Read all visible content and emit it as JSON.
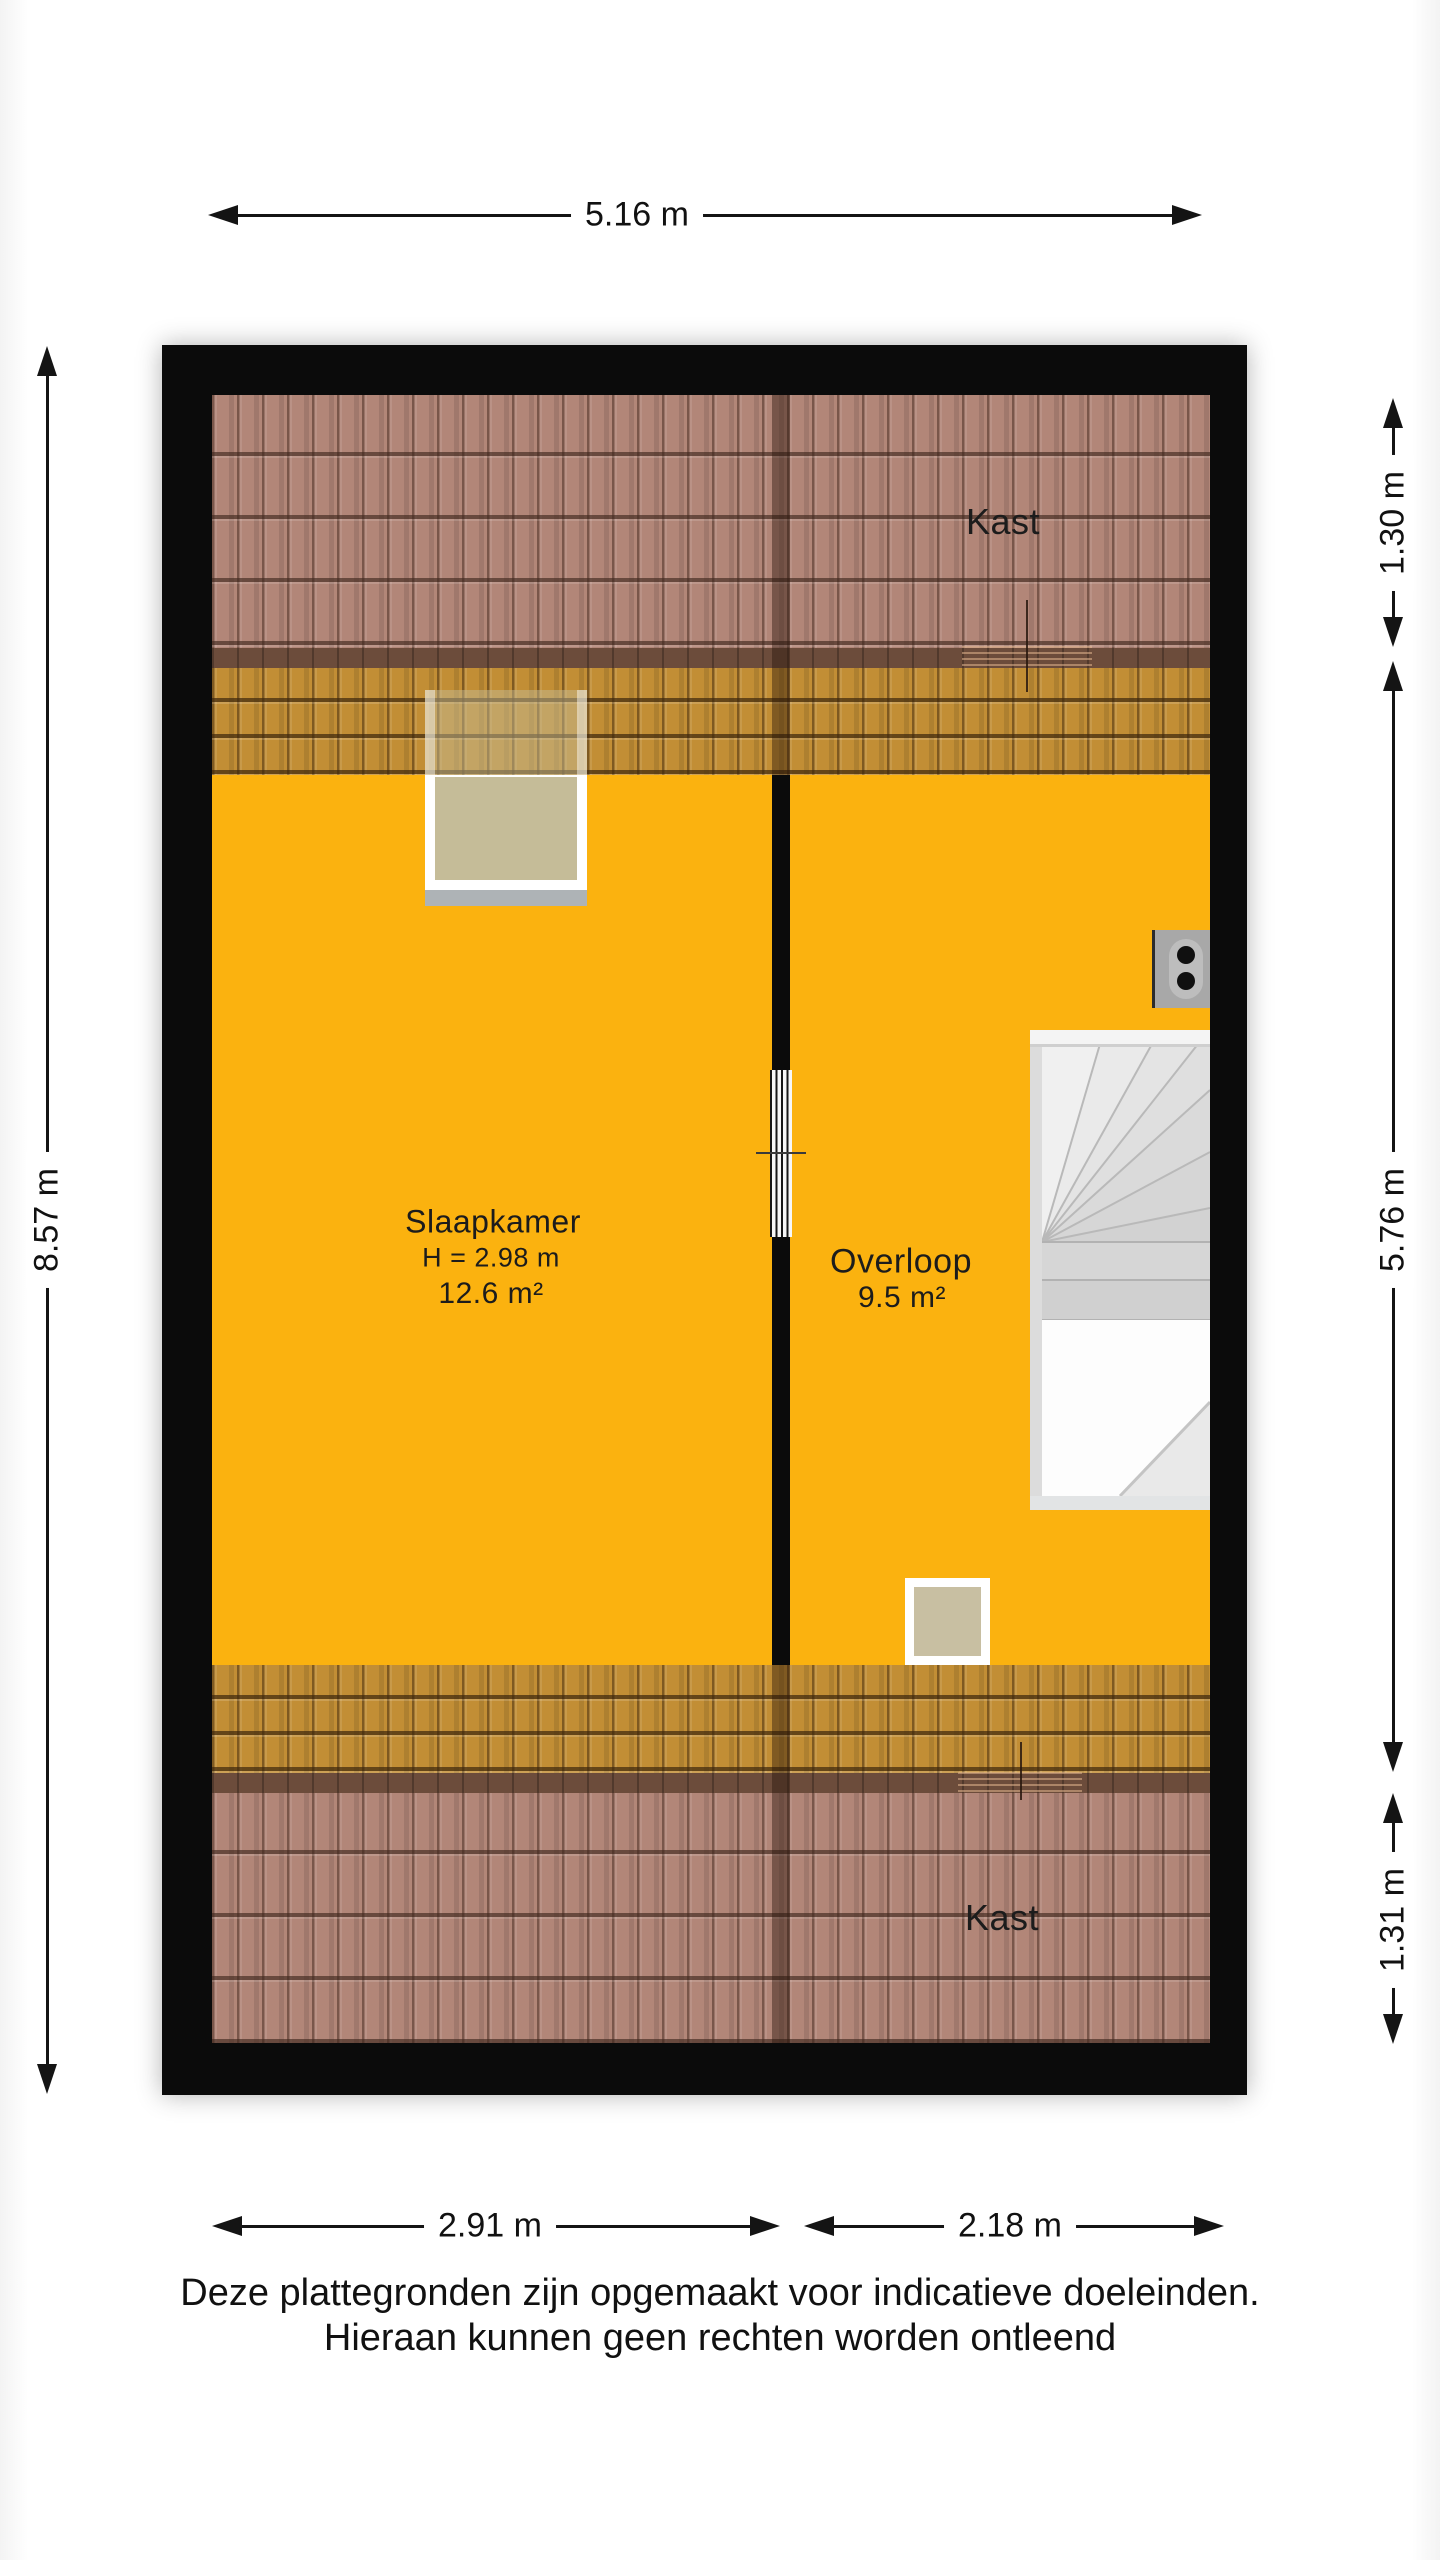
{
  "floorplan": {
    "rooms": {
      "kast_top": {
        "label": "Kast"
      },
      "slaapkamer": {
        "label": "Slaapkamer",
        "ceiling_height": "H = 2.98 m",
        "area": "12.6 m²"
      },
      "overloop": {
        "label": "Overloop",
        "area": "9.5 m²"
      },
      "kast_bottom": {
        "label": "Kast"
      }
    },
    "dimensions": {
      "top_width": "5.16 m",
      "left_height": "8.57 m",
      "right_top": "1.30 m",
      "right_middle": "5.76 m",
      "right_bottom": "1.31 m",
      "bottom_left_width": "2.91 m",
      "bottom_right_width": "2.18 m"
    },
    "colors": {
      "floor": "#FBB20F",
      "roof_tiles_outer": "#B28678",
      "roof_tiles_inner": "#C28E35",
      "knee_wall_band": "#6C4C3B",
      "wall": "#0B0B0B"
    }
  },
  "footer": {
    "disclaimer_line1": "Deze plattegronden zijn opgemaakt voor indicatieve doeleinden.",
    "disclaimer_line2": "Hieraan kunnen geen rechten worden ontleend"
  }
}
